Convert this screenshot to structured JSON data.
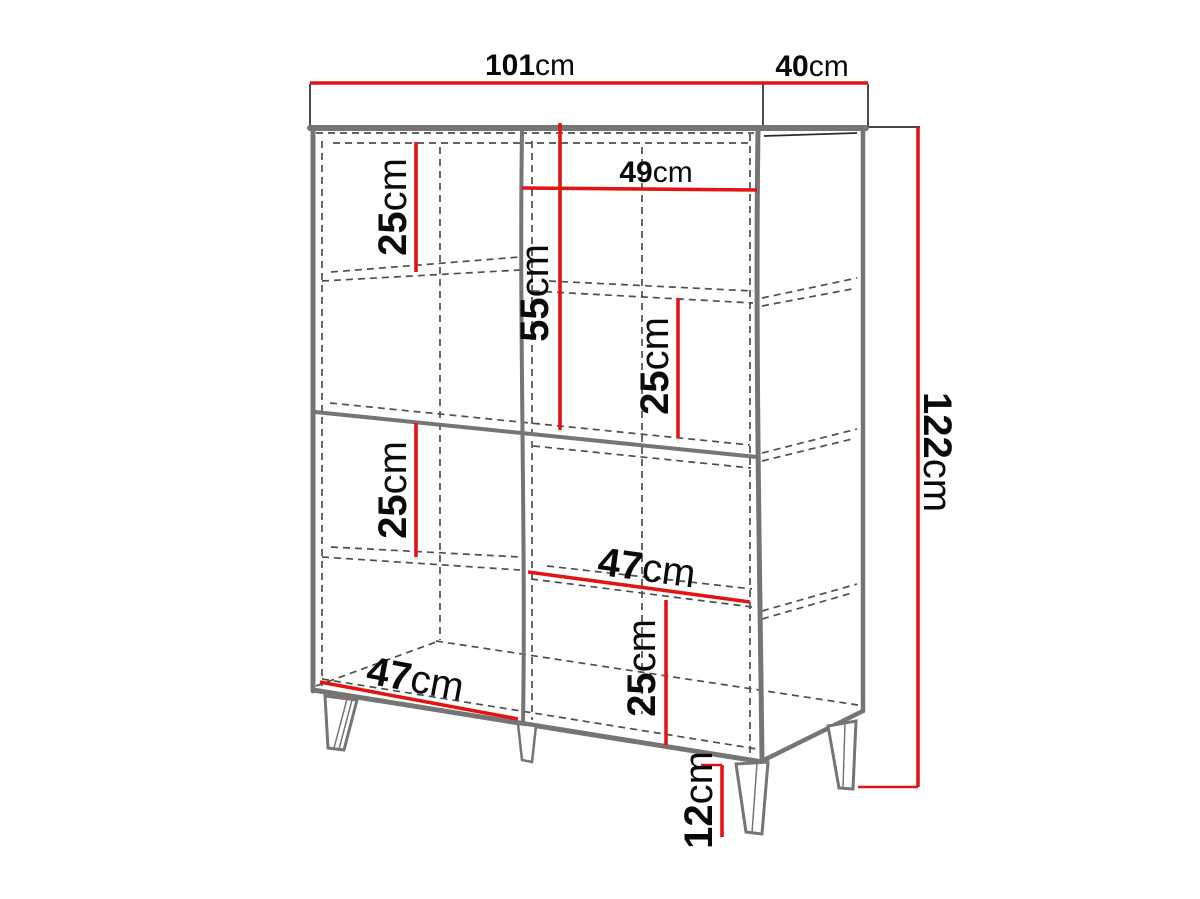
{
  "figure": {
    "unit": "cm",
    "colors": {
      "dimension": "#e41414",
      "outline": "#757575",
      "hidden_edge": "#4f4f4f",
      "slab_edge": "#2b2b2b",
      "text": "#0a0a0a",
      "background": "#ffffff"
    },
    "dimensions": {
      "overall_width": {
        "value": "101",
        "unit": "cm"
      },
      "overall_depth": {
        "value": "40",
        "unit": "cm"
      },
      "overall_height": {
        "value": "122",
        "unit": "cm"
      },
      "upper_right_width": {
        "value": "49",
        "unit": "cm"
      },
      "upper_middle_height": {
        "value": "55",
        "unit": "cm"
      },
      "upper_left_shelf": {
        "value": "25",
        "unit": "cm"
      },
      "upper_right_shelf": {
        "value": "25",
        "unit": "cm"
      },
      "lower_left_shelf": {
        "value": "25",
        "unit": "cm"
      },
      "lower_right_shelf": {
        "value": "25",
        "unit": "cm"
      },
      "lower_right_width": {
        "value": "47",
        "unit": "cm"
      },
      "bottom_left_width": {
        "value": "47",
        "unit": "cm"
      },
      "leg_height": {
        "value": "12",
        "unit": "cm"
      }
    }
  }
}
